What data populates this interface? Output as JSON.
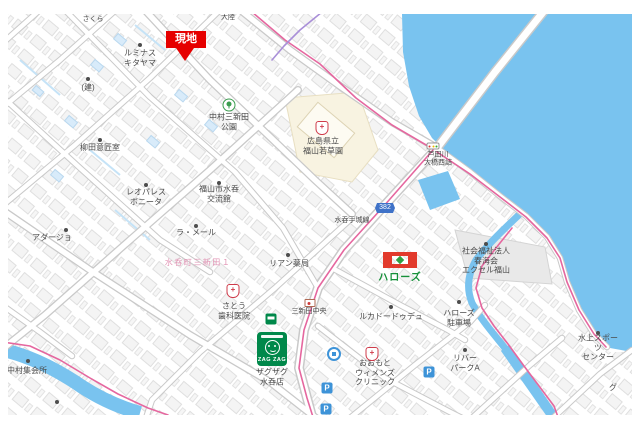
{
  "marker": {
    "text": "現地",
    "color": "#e60000"
  },
  "road_badge": {
    "number": "382"
  },
  "parking_letter": "P",
  "logos": {
    "halows_text": "ハローズ",
    "zagzag_text": "ZAG ZAG"
  },
  "labels": {
    "sakura": "さくら",
    "tairiku": "大陸",
    "luminous": "ルミナス\nキタヤマ",
    "ken": "(建)",
    "park": "中村三新田\n公園",
    "wakakusaen": "広島県立\n福山若草園",
    "yanagida": "柳田意匠室",
    "leopalace": "レオパレス\nボニータ",
    "kouryukan": "福山市水呑\n交流館",
    "ashidagawa_bridge": "芦田川\n大橋西詰",
    "mizunomi_tejo_line": "水呑手城線",
    "adagio": "アダージョ",
    "la_mer": "ラ・メール",
    "town_pink": "水呑町三新田１",
    "lien_pharmacy": "リアン薬局",
    "sato_dental": "さとう\n歯科医院",
    "sanshinden_chuo": "三新田中央",
    "zagzag_store": "ザグザグ\n水呑店",
    "luca": "ルカドードゥデュ",
    "halows_parking": "ハローズ\n駐車場",
    "excel_fukuyama": "社会福祉法人\n春海会\nエクセル福山",
    "omoto_clinic": "おおもと\nウィメンズ\nクリニック",
    "river_park": "リバー\nパークA",
    "suijo_sports": "水上スポーツ\nセンター",
    "nakamura_hall": "中村集会所",
    "gu_partial": "グ"
  },
  "colors": {
    "water": "#79c3ef",
    "route_pink": "#e5679f",
    "boundary_purple": "#a98fd8",
    "marker_red": "#e60000",
    "halows_red": "#e23a2c",
    "halows_green": "#17903a",
    "zagzag_green": "#00884a",
    "parking_blue": "#3d93d8"
  }
}
